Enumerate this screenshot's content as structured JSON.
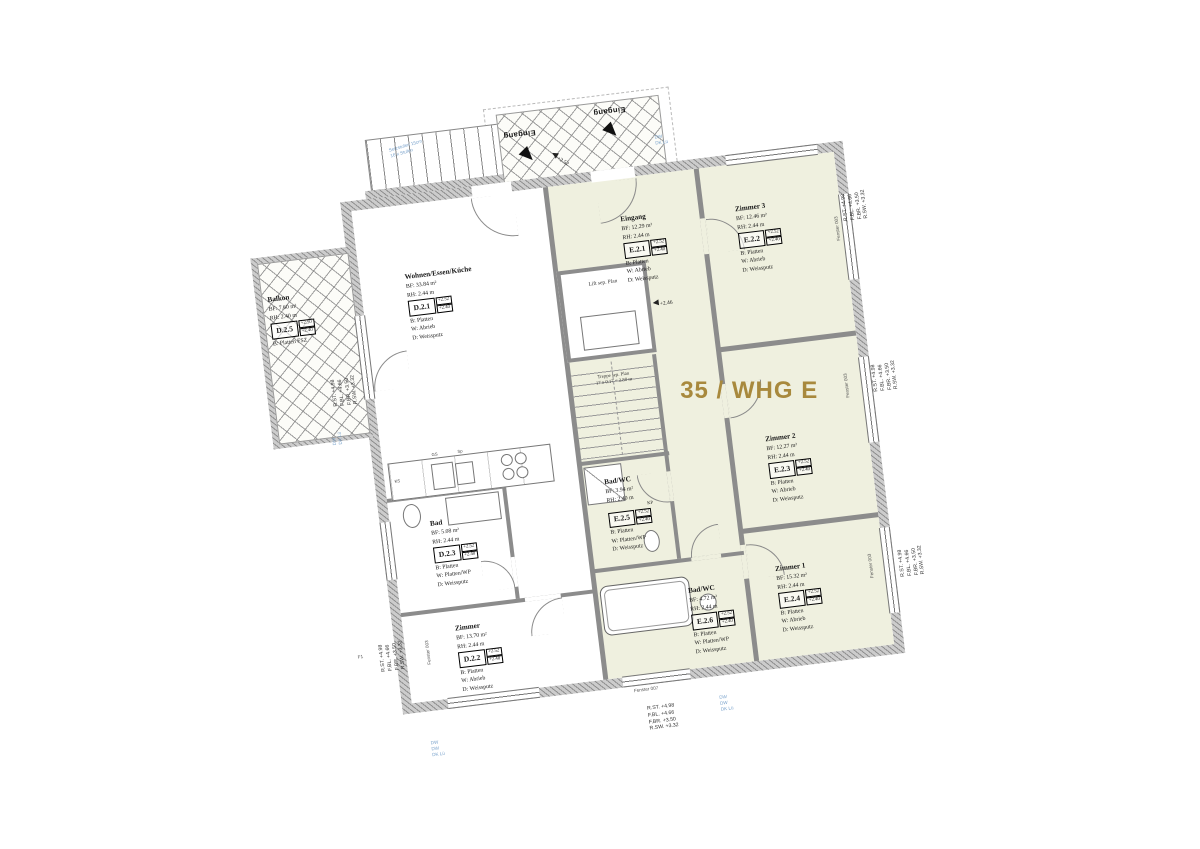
{
  "title": "35 / WHG E",
  "rooms": [
    {
      "id": "D.2.1",
      "name": "Wohnen/Essen/Küche",
      "bf": "BF: 33.84 m²",
      "rh": "RH: 2.44 m",
      "lvl_top": "+2.52",
      "lvl_bot": "+2.40",
      "b": "B: Platten",
      "w": "W: Abrieb",
      "d": "D: Weissputz"
    },
    {
      "id": "D.2.5",
      "name": "Balkon",
      "bf": "BF: 7.60 m²",
      "rh": "RH: 2.40 m",
      "lvl_top": "+2.50",
      "lvl_bot": "+2.40",
      "b": "B: Platten FSZ"
    },
    {
      "id": "D.2.3",
      "name": "Bad",
      "bf": "BF: 5.08 m²",
      "rh": "RH: 2.44 m",
      "lvl_top": "+2.52",
      "lvl_bot": "+2.40",
      "b": "B: Platten",
      "w": "W: Platten/WP",
      "d": "D: Weissputz"
    },
    {
      "id": "D.2.2",
      "name": "Zimmer",
      "bf": "BF: 13.70 m²",
      "rh": "RH: 2.44 m",
      "lvl_top": "+2.52",
      "lvl_bot": "+2.40",
      "b": "B: Platten",
      "w": "W: Abrieb",
      "d": "D: Weissputz"
    },
    {
      "id": "E.2.1",
      "name": "Eingang",
      "bf": "BF: 12.29 m²",
      "rh": "RH: 2.44 m",
      "lvl_top": "+2.52",
      "lvl_bot": "+2.40",
      "b": "B: Platten",
      "w": "W: Abrieb",
      "d": "D: Weissputz"
    },
    {
      "id": "E.2.2",
      "name": "Zimmer 3",
      "bf": "BF: 12.46 m²",
      "rh": "RH: 2.44 m",
      "lvl_top": "+2.52",
      "lvl_bot": "+2.40",
      "b": "B: Platten",
      "w": "W: Abrieb",
      "d": "D: Weissputz"
    },
    {
      "id": "E.2.3",
      "name": "Zimmer 2",
      "bf": "BF: 12.27 m²",
      "rh": "RH: 2.44 m",
      "lvl_top": "+2.52",
      "lvl_bot": "+2.40",
      "b": "B: Platten",
      "w": "W: Abrieb",
      "d": "D: Weissputz"
    },
    {
      "id": "E.2.4",
      "name": "Zimmer 1",
      "bf": "BF: 15.32 m²",
      "rh": "RH: 2.44 m",
      "lvl_top": "+2.52",
      "lvl_bot": "+2.40",
      "b": "B: Platten",
      "w": "W: Abrieb",
      "d": "D: Weissputz"
    },
    {
      "id": "E.2.5",
      "name": "Bad/WC",
      "bf": "BF: 3.94 m²",
      "rh": "RH: 2.40 m",
      "kp": "KP",
      "lvl_top": "+2.52",
      "lvl_bot": "+2.40",
      "b": "B: Platten",
      "w": "W: Platten/WP",
      "d": "D: Weissputz"
    },
    {
      "id": "E.2.6",
      "name": "Bad/WC",
      "bf": "BF: 4.72 m²",
      "rh": "RH: 2.44 m",
      "lvl_top": "+2.52",
      "lvl_bot": "+2.40",
      "b": "B: Platten",
      "w": "W: Platten/WP",
      "d": "D: Weissputz"
    }
  ],
  "core": {
    "lift": "Lift sep. Plan",
    "stair_line1": "Treppe sep. Plan",
    "stair_line2": "17 x 0.17 = 2.80 m"
  },
  "entrance": {
    "label": "Eingang",
    "level": "+2.52",
    "level_inner": "+2.46",
    "stair_note1": "Setzstufen 15cm",
    "stair_note2": "16 x Stufen"
  },
  "elevation": {
    "l1": "R.ST. +4.98",
    "l2": "F.BL. +4.66",
    "l3": "F.BR. +3.50",
    "l4": "R.SW. +3.32"
  },
  "window_labels": {
    "fenster003": "Fenster 003",
    "fenster007": "Fenster 007"
  },
  "misc": {
    "f1": "F1",
    "ks": "KS",
    "gs": "GS",
    "sp": "Sp",
    "dw": "DW",
    "dk": "DK Lü"
  },
  "colors": {
    "unit_e_fill": "#eff0df",
    "title": "#a8893d",
    "annotation_blue": "#7aa3cc"
  }
}
